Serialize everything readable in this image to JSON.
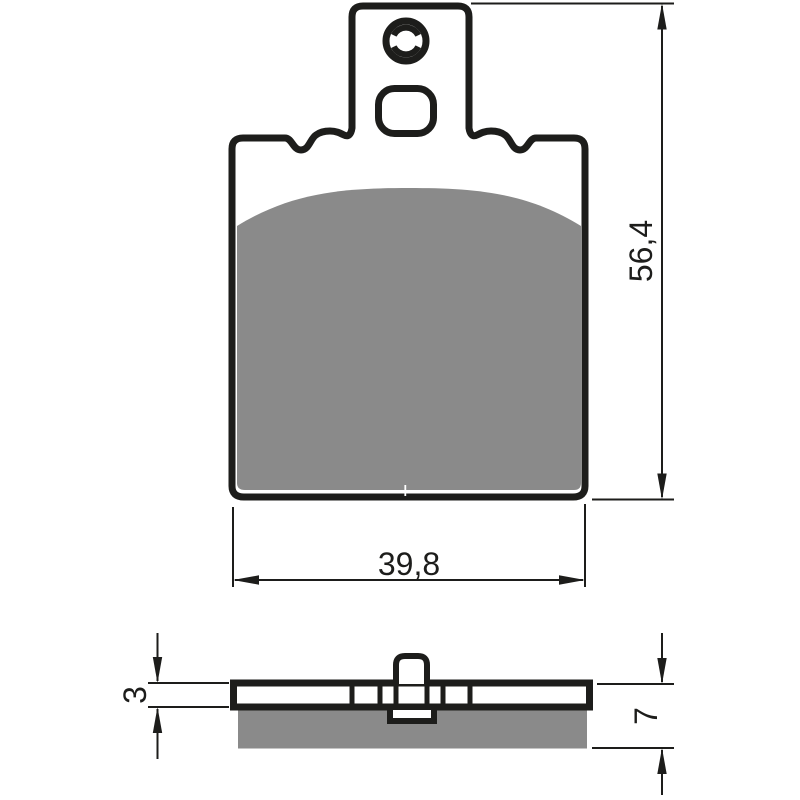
{
  "colors": {
    "line": "#1d1d1b",
    "pad": "#8a8a8a",
    "paper": "#ffffff"
  },
  "dimensions": {
    "height": "56,4",
    "width": "39,8",
    "plate_thickness": "3",
    "total_thickness": "7"
  }
}
